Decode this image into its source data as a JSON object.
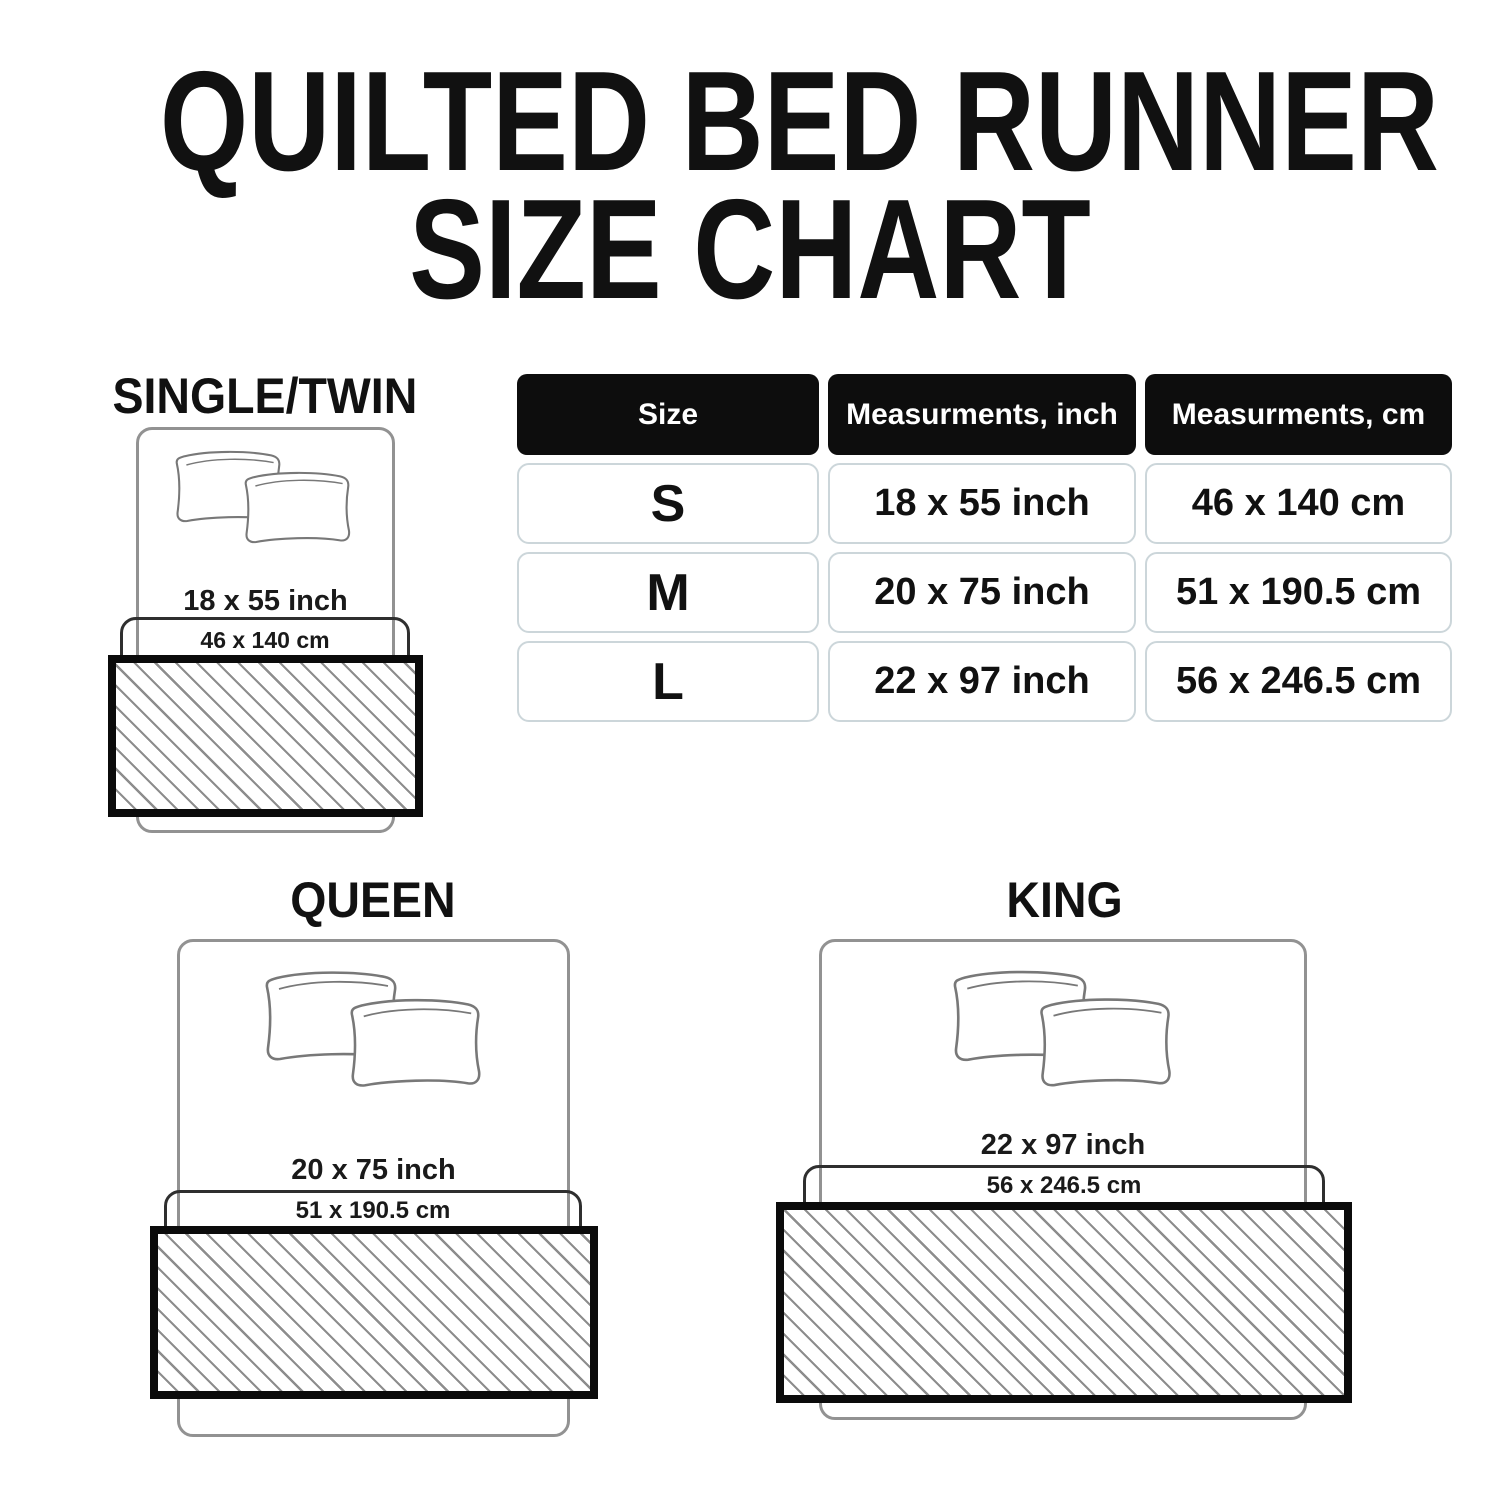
{
  "title": {
    "line1": "QUILTED BED RUNNER",
    "line2": "SIZE CHART"
  },
  "table": {
    "headers": [
      "Size",
      "Measurments, inch",
      "Measurments, cm"
    ],
    "rows": [
      {
        "size": "S",
        "inch": "18 x 55 inch",
        "cm": "46 x 140 cm"
      },
      {
        "size": "M",
        "inch": "20 x 75 inch",
        "cm": "51 x 190.5 cm"
      },
      {
        "size": "L",
        "inch": "22 x 97 inch",
        "cm": "56 x 246.5 cm"
      }
    ]
  },
  "diagrams": [
    {
      "label": "SINGLE/TWIN",
      "inch": "18 x 55 inch",
      "cm": "46 x 140 cm"
    },
    {
      "label": "QUEEN",
      "inch": "20 x 75 inch",
      "cm": "51 x 190.5 cm"
    },
    {
      "label": "KING",
      "inch": "22 x 97 inch",
      "cm": "56 x 246.5 cm"
    }
  ],
  "chart_data": {
    "type": "table",
    "title": "QUILTED BED RUNNER SIZE CHART",
    "columns": [
      "Size",
      "Measurments, inch",
      "Measurments, cm"
    ],
    "rows": [
      [
        "S",
        "18 x 55 inch",
        "46 x 140 cm"
      ],
      [
        "M",
        "20 x 75 inch",
        "51 x 190.5 cm"
      ],
      [
        "L",
        "22 x 97 inch",
        "56 x 246.5 cm"
      ]
    ]
  },
  "colors": {
    "background": "#ffffff",
    "text": "#111111",
    "header_fill": "#0d0d0d",
    "header_text": "#ffffff",
    "cell_border": "#ccd6da",
    "bed_outline": "#929292",
    "cm_box_outline": "#2f2f2f",
    "runner_border": "#0b0b0b",
    "hatch_line": "#8d8d8d"
  }
}
